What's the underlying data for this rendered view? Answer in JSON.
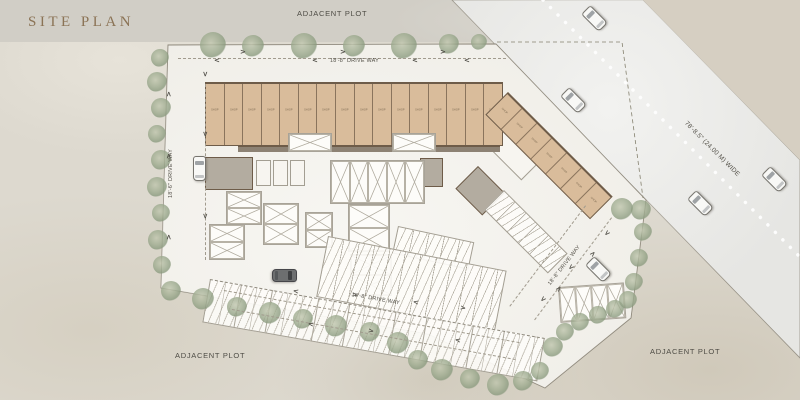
{
  "title": "SITE PLAN",
  "labels": {
    "adjacent_top": "ADJACENT PLOT",
    "adjacent_bottom_left": "ADJACENT PLOT",
    "adjacent_bottom_right": "ADJACENT PLOT"
  },
  "road": {
    "width_label": "78'-8.5\" (24.00 M) WIDE"
  },
  "driveways": {
    "top": "18'-8\" DRIVE WAY",
    "left": "18'-6\" DRIVE WAY",
    "bottom": "18'-8\" DRIVE WAY",
    "right": "18'-8\" DRIVE WAY"
  },
  "building": {
    "shop_label": "SHOP",
    "top_row_units": 16,
    "wing_units": 7
  },
  "colors": {
    "shop_fill": "#d9bc9b",
    "wall": "#6e5c49",
    "site_fill": "#f0eee8",
    "road_fill": "#e6e6e3",
    "tree_green": "#9fac90",
    "title_color": "#8b7355",
    "label_color": "#4e4c45"
  },
  "trees": [
    [
      213,
      45,
      13
    ],
    [
      253,
      46,
      11
    ],
    [
      304,
      46,
      13
    ],
    [
      354,
      46,
      11
    ],
    [
      404,
      46,
      13
    ],
    [
      449,
      44,
      10
    ],
    [
      479,
      42,
      8
    ],
    [
      160,
      58,
      9
    ],
    [
      157,
      82,
      10
    ],
    [
      161,
      108,
      10
    ],
    [
      157,
      134,
      9
    ],
    [
      161,
      160,
      10
    ],
    [
      157,
      187,
      10
    ],
    [
      161,
      213,
      9
    ],
    [
      158,
      240,
      10
    ],
    [
      162,
      265,
      9
    ],
    [
      171,
      291,
      10
    ],
    [
      203,
      299,
      11
    ],
    [
      237,
      307,
      10
    ],
    [
      270,
      313,
      11
    ],
    [
      303,
      319,
      10
    ],
    [
      336,
      326,
      11
    ],
    [
      370,
      332,
      10
    ],
    [
      398,
      343,
      11
    ],
    [
      418,
      360,
      10
    ],
    [
      442,
      370,
      11
    ],
    [
      470,
      379,
      10
    ],
    [
      498,
      385,
      11
    ],
    [
      523,
      381,
      10
    ],
    [
      540,
      371,
      9
    ],
    [
      553,
      347,
      10
    ],
    [
      565,
      332,
      9
    ],
    [
      580,
      322,
      9
    ],
    [
      598,
      315,
      9
    ],
    [
      615,
      309,
      9
    ],
    [
      628,
      300,
      9
    ],
    [
      634,
      282,
      9
    ],
    [
      639,
      258,
      9
    ],
    [
      643,
      232,
      9
    ],
    [
      641,
      210,
      10
    ],
    [
      622,
      209,
      11
    ]
  ],
  "cars": [
    [
      593,
      17,
      -45,
      0
    ],
    [
      572,
      99,
      -45,
      0
    ],
    [
      773,
      178,
      -45,
      0
    ],
    [
      699,
      202,
      -45,
      0
    ],
    [
      597,
      268,
      -45,
      0
    ],
    [
      198,
      167,
      0,
      0
    ],
    [
      283,
      274,
      90,
      1
    ]
  ],
  "arrows": [
    [
      240,
      48,
      0
    ],
    [
      340,
      48,
      0
    ],
    [
      440,
      48,
      0
    ],
    [
      214,
      56,
      180
    ],
    [
      312,
      56,
      180
    ],
    [
      412,
      56,
      180
    ],
    [
      464,
      56,
      180
    ],
    [
      166,
      90,
      -90
    ],
    [
      166,
      152,
      -90
    ],
    [
      166,
      233,
      -90
    ],
    [
      202,
      70,
      90
    ],
    [
      202,
      130,
      90
    ],
    [
      202,
      212,
      90
    ],
    [
      293,
      287,
      190
    ],
    [
      352,
      291,
      10
    ],
    [
      413,
      298,
      190
    ],
    [
      460,
      304,
      10
    ],
    [
      308,
      320,
      190
    ],
    [
      368,
      327,
      10
    ],
    [
      455,
      336,
      190
    ],
    [
      604,
      229,
      135
    ],
    [
      568,
      263,
      135
    ],
    [
      540,
      295,
      135
    ],
    [
      590,
      250,
      -45
    ],
    [
      556,
      285,
      -45
    ]
  ]
}
